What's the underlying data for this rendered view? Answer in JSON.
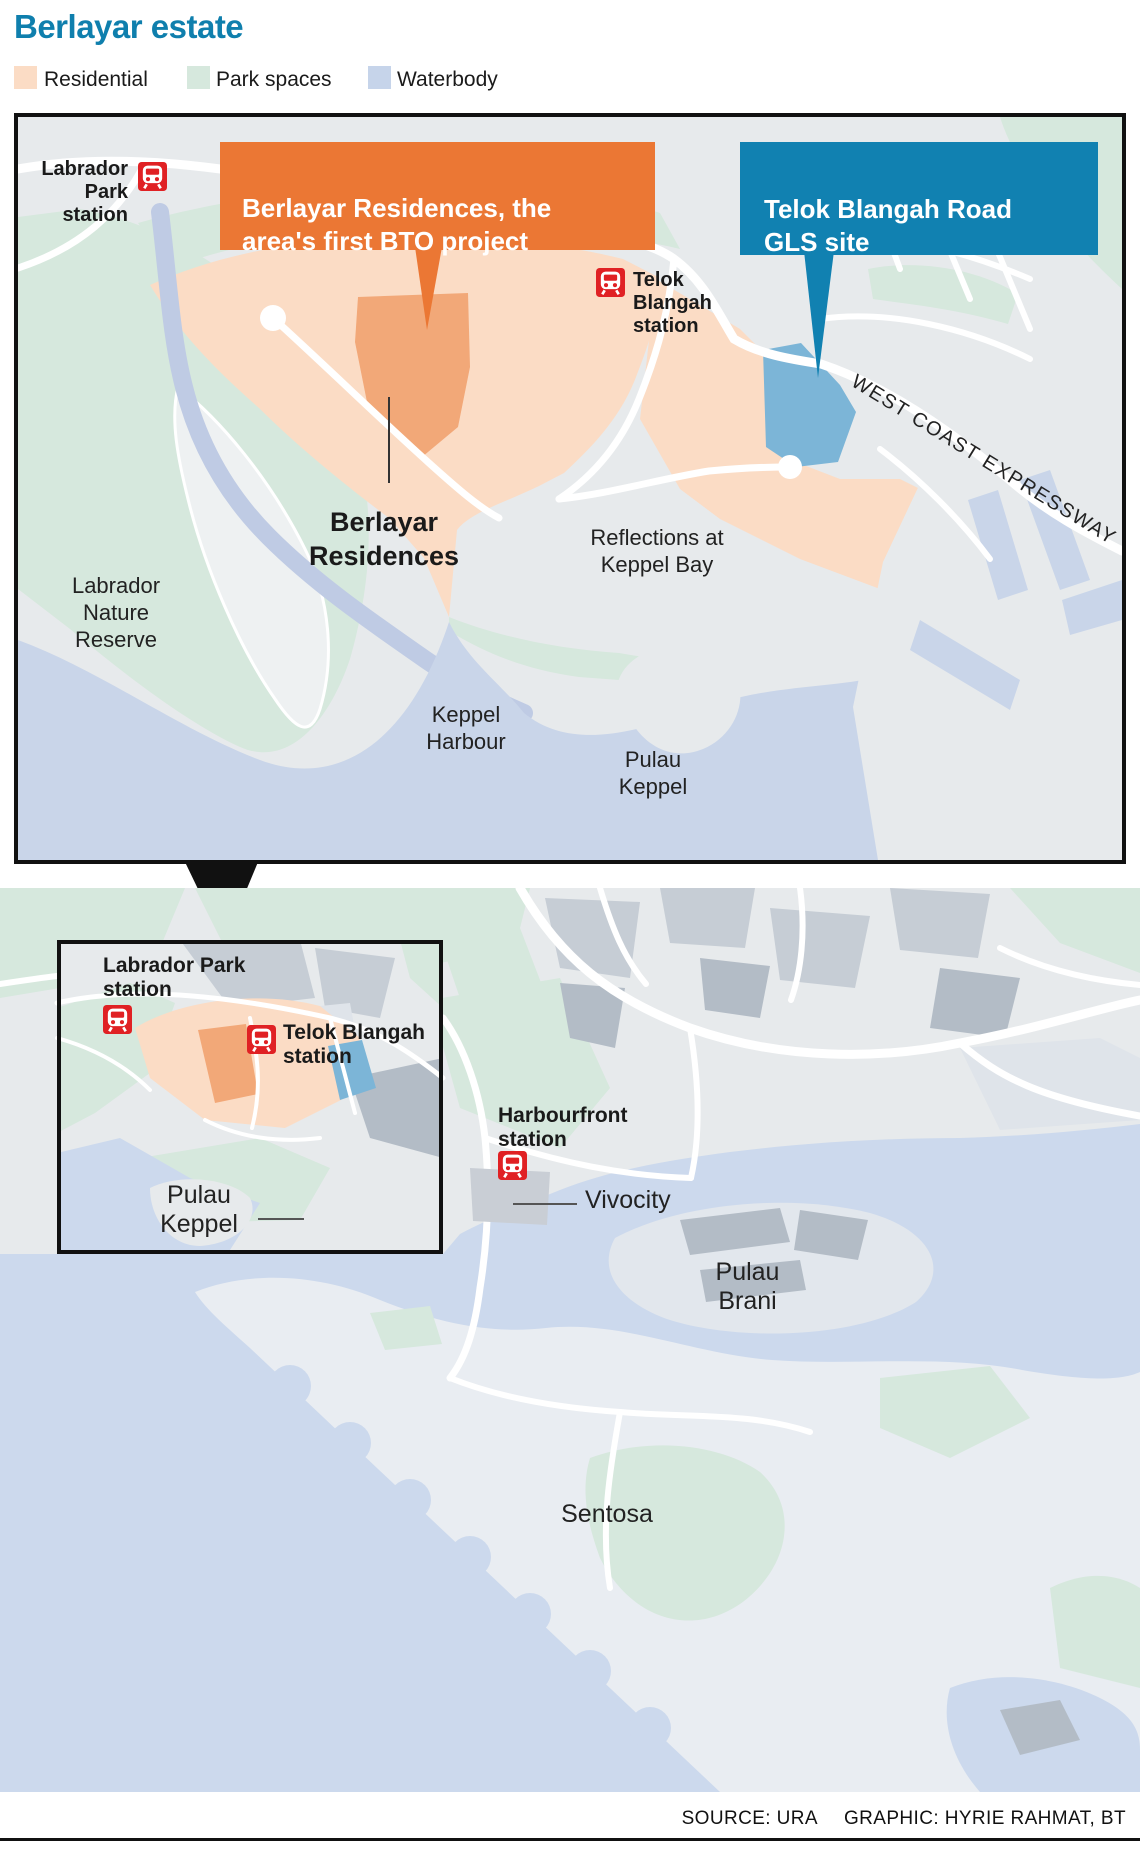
{
  "title": "Berlayar estate",
  "colors": {
    "title": "#0f7fad",
    "residential": "#fbdcc5",
    "residential_dark": "#f2a878",
    "park": "#d6e8dd",
    "waterbody": "#c6d4ea",
    "water_top": "#c9d5e9",
    "water_bottom": "#ccd9ed",
    "land": "#e7eaec",
    "land_light": "#eef1f2",
    "land_mid": "#dfe4ea",
    "building": "#c6cdd5",
    "building_dark": "#b3bcc6",
    "sentosa_land": "#e9edf2",
    "brani_land": "#e2e7ed",
    "gls_site": "#7cb5d7",
    "creek": "#bfcbe4",
    "callout_orange": "#eb7734",
    "callout_blue": "#1181b1",
    "mrt_red": "#e02124",
    "ink": "#1a1a1a"
  },
  "legend": [
    {
      "label": "Residential"
    },
    {
      "label": "Park spaces"
    },
    {
      "label": "Waterbody"
    }
  ],
  "map_top": {
    "callout_bto": "Berlayar Residences, the\narea's first BTO project",
    "callout_gls": "Telok Blangah Road\nGLS site",
    "station_labrador": "Labrador\nPark\nstation",
    "station_telok": "Telok\nBlangah\nstation",
    "berlayar_residences": "Berlayar\nResidences",
    "reflections": "Reflections at\nKeppel Bay",
    "nature_reserve": "Labrador\nNature\nReserve",
    "keppel_harbour": "Keppel\nHarbour",
    "pulau_keppel": "Pulau\nKeppel",
    "expressway": "WEST COAST EXPRESSWAY"
  },
  "map_bottom": {
    "station_labrador": "Labrador Park\nstation",
    "station_telok": "Telok Blangah\nstation",
    "station_harbourfront": "Harbourfront\nstation",
    "vivocity": "Vivocity",
    "pulau_keppel": "Pulau\nKeppel",
    "pulau_brani": "Pulau\nBrani",
    "sentosa": "Sentosa"
  },
  "footer": {
    "source": "SOURCE: URA",
    "credit": "GRAPHIC: HYRIE RAHMAT, BT"
  }
}
